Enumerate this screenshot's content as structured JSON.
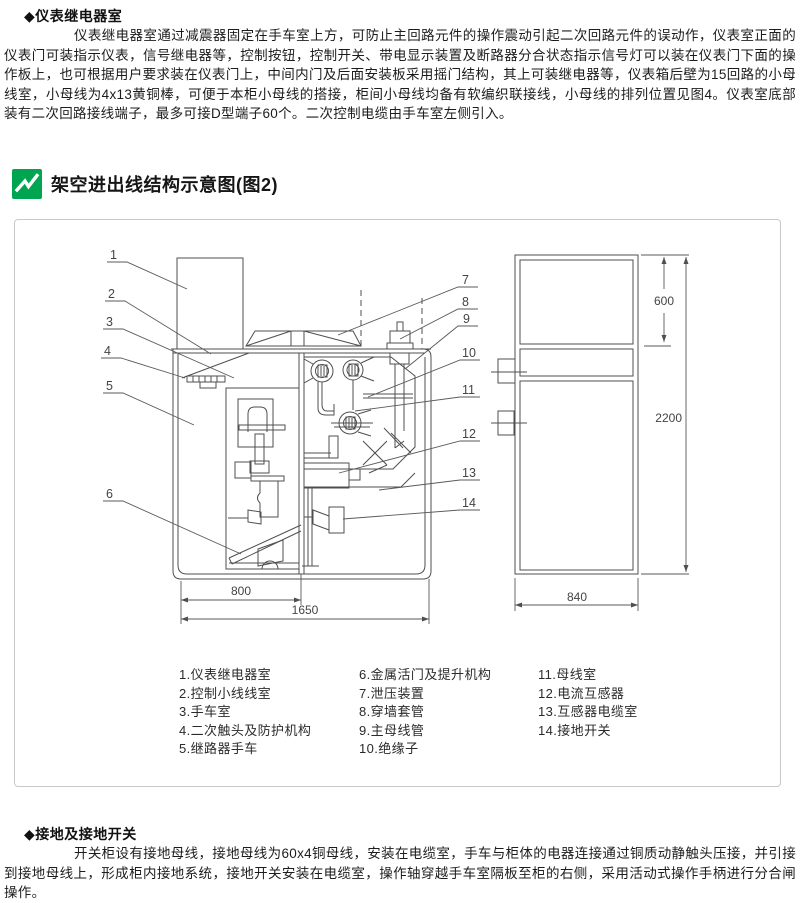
{
  "section1": {
    "bullet": "◆",
    "title": "仪表继电器室",
    "paragraph": "仪表继电器室通过减震器固定在手车室上方，可防止主回路元件的操作震动引起二次回路元件的误动作，仪表室正面的仪表门可装指示仪表，信号继电器等，控制按钮，控制开关、带电显示装置及断路器分合状态指示信号灯可以装在仪表门下面的操作板上，也可根据用户要求装在仪表门上，中间内门及后面安装板采用摇门结构，其上可装继电器等，仪表箱后壁为15回路的小母线室，小母线为4x13黄铜棒，可便于本柜小母线的搭接，柜间小母线均备有软编织联接线，小母线的排列位置见图4。仪表室底部装有二次回路接线端子，最多可接D型端子60个。二次控制电缆由手车室左侧引入。"
  },
  "figure": {
    "title": "架空进出线结构示意图(图2)",
    "icon_color": "#00a551",
    "callouts": [
      "1",
      "2",
      "3",
      "4",
      "5",
      "6",
      "7",
      "8",
      "9",
      "10",
      "11",
      "12",
      "13",
      "14"
    ],
    "dims": {
      "w800": "800",
      "w1650": "1650",
      "h600": "600",
      "h2200": "2200",
      "w840": "840"
    },
    "legend": {
      "col1": [
        "1.仪表继电器室",
        "2.控制小线线室",
        "3.手车室",
        "4.二次触头及防护机构",
        "5.继路器手车"
      ],
      "col2": [
        "6.金属活门及提升机构",
        "7.泄压装置",
        "8.穿墙套管",
        "9.主母线管",
        "10.绝缘子"
      ],
      "col3": [
        "11.母线室",
        "12.电流互感器",
        "13.互感器电缆室",
        "14.接地开关"
      ]
    }
  },
  "section2": {
    "bullet": "◆",
    "title": "接地及接地开关",
    "paragraph": "开关柜设有接地母线，接地母线为60x4铜母线，安装在电缆室，手车与柜体的电器连接通过铜质动静触头压接，并引接到接地母线上，形成柜内接地系统，接地开关安装在电缆室，操作轴穿越手车室隔板至柜的右侧，采用活动式操作手柄进行分合闸操作。"
  }
}
